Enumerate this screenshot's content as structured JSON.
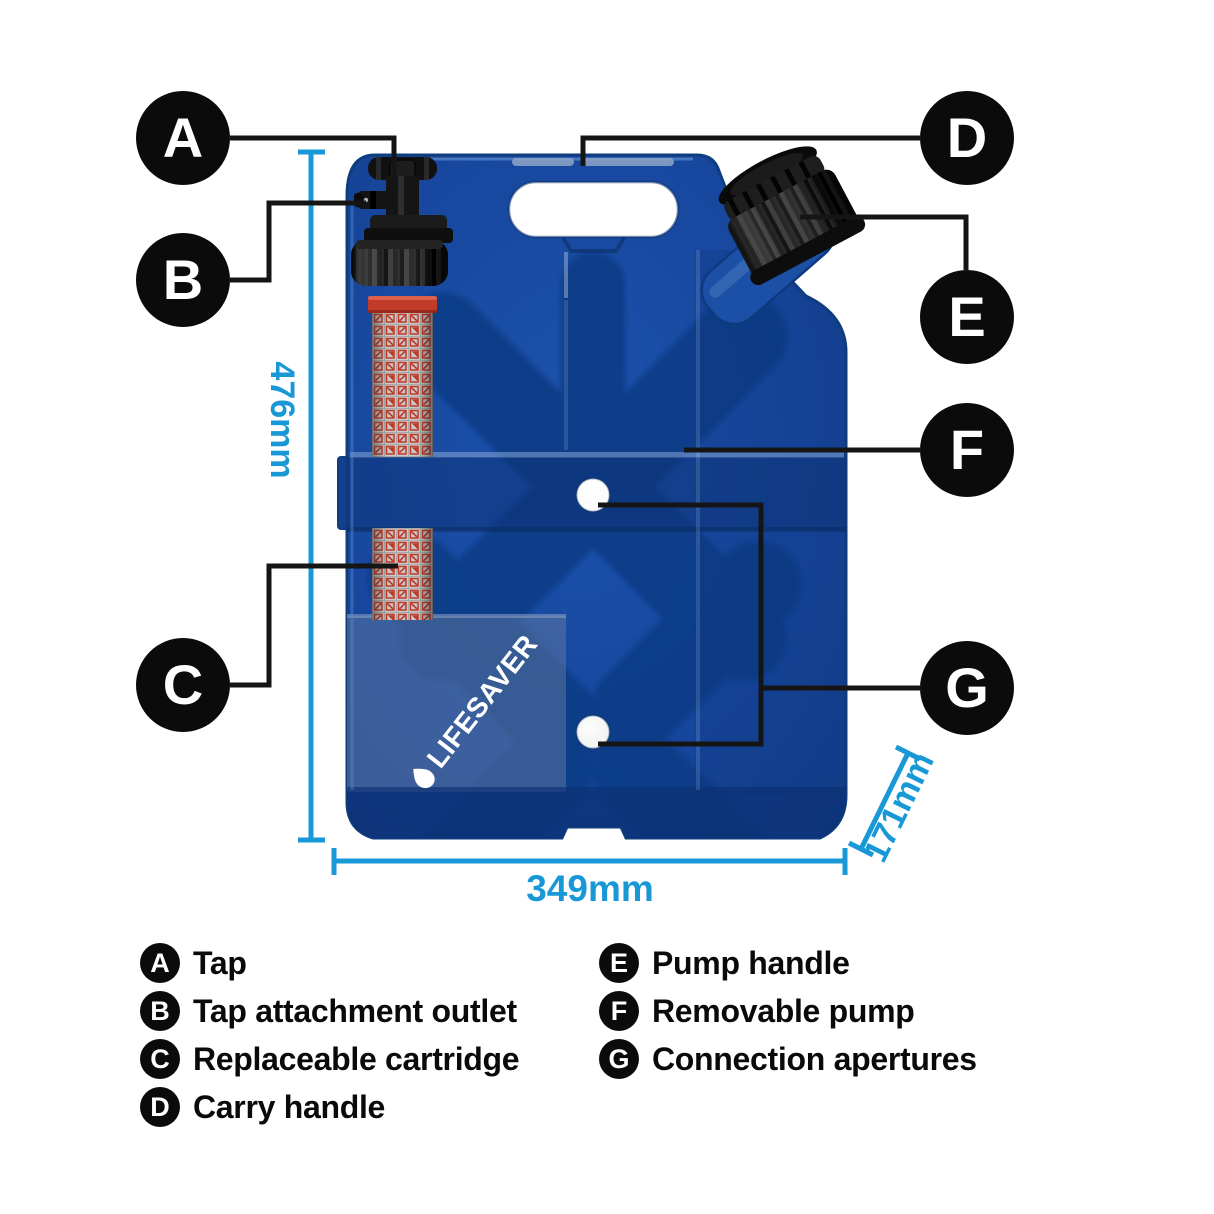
{
  "title": "LifeSaver jerrycan water filter labelled diagram",
  "callouts": {
    "a": {
      "letter": "A",
      "label": "Tap"
    },
    "b": {
      "letter": "B",
      "label": "Tap attachment outlet"
    },
    "c": {
      "letter": "C",
      "label": "Replaceable cartridge"
    },
    "d": {
      "letter": "D",
      "label": "Carry handle"
    },
    "e": {
      "letter": "E",
      "label": "Pump handle"
    },
    "f": {
      "letter": "F",
      "label": "Removable pump"
    },
    "g": {
      "letter": "G",
      "label": "Connection apertures"
    }
  },
  "dimensions": {
    "height": "476mm",
    "width": "349mm",
    "depth": "171mm"
  },
  "logo": {
    "text": "LIFESAVER"
  },
  "colors": {
    "body_blue": "#17489E",
    "dimension_blue": "#1898D7",
    "cartridge_red": "#C23A28",
    "badge_black": "#0B0B0B",
    "leader_black": "#151515"
  }
}
